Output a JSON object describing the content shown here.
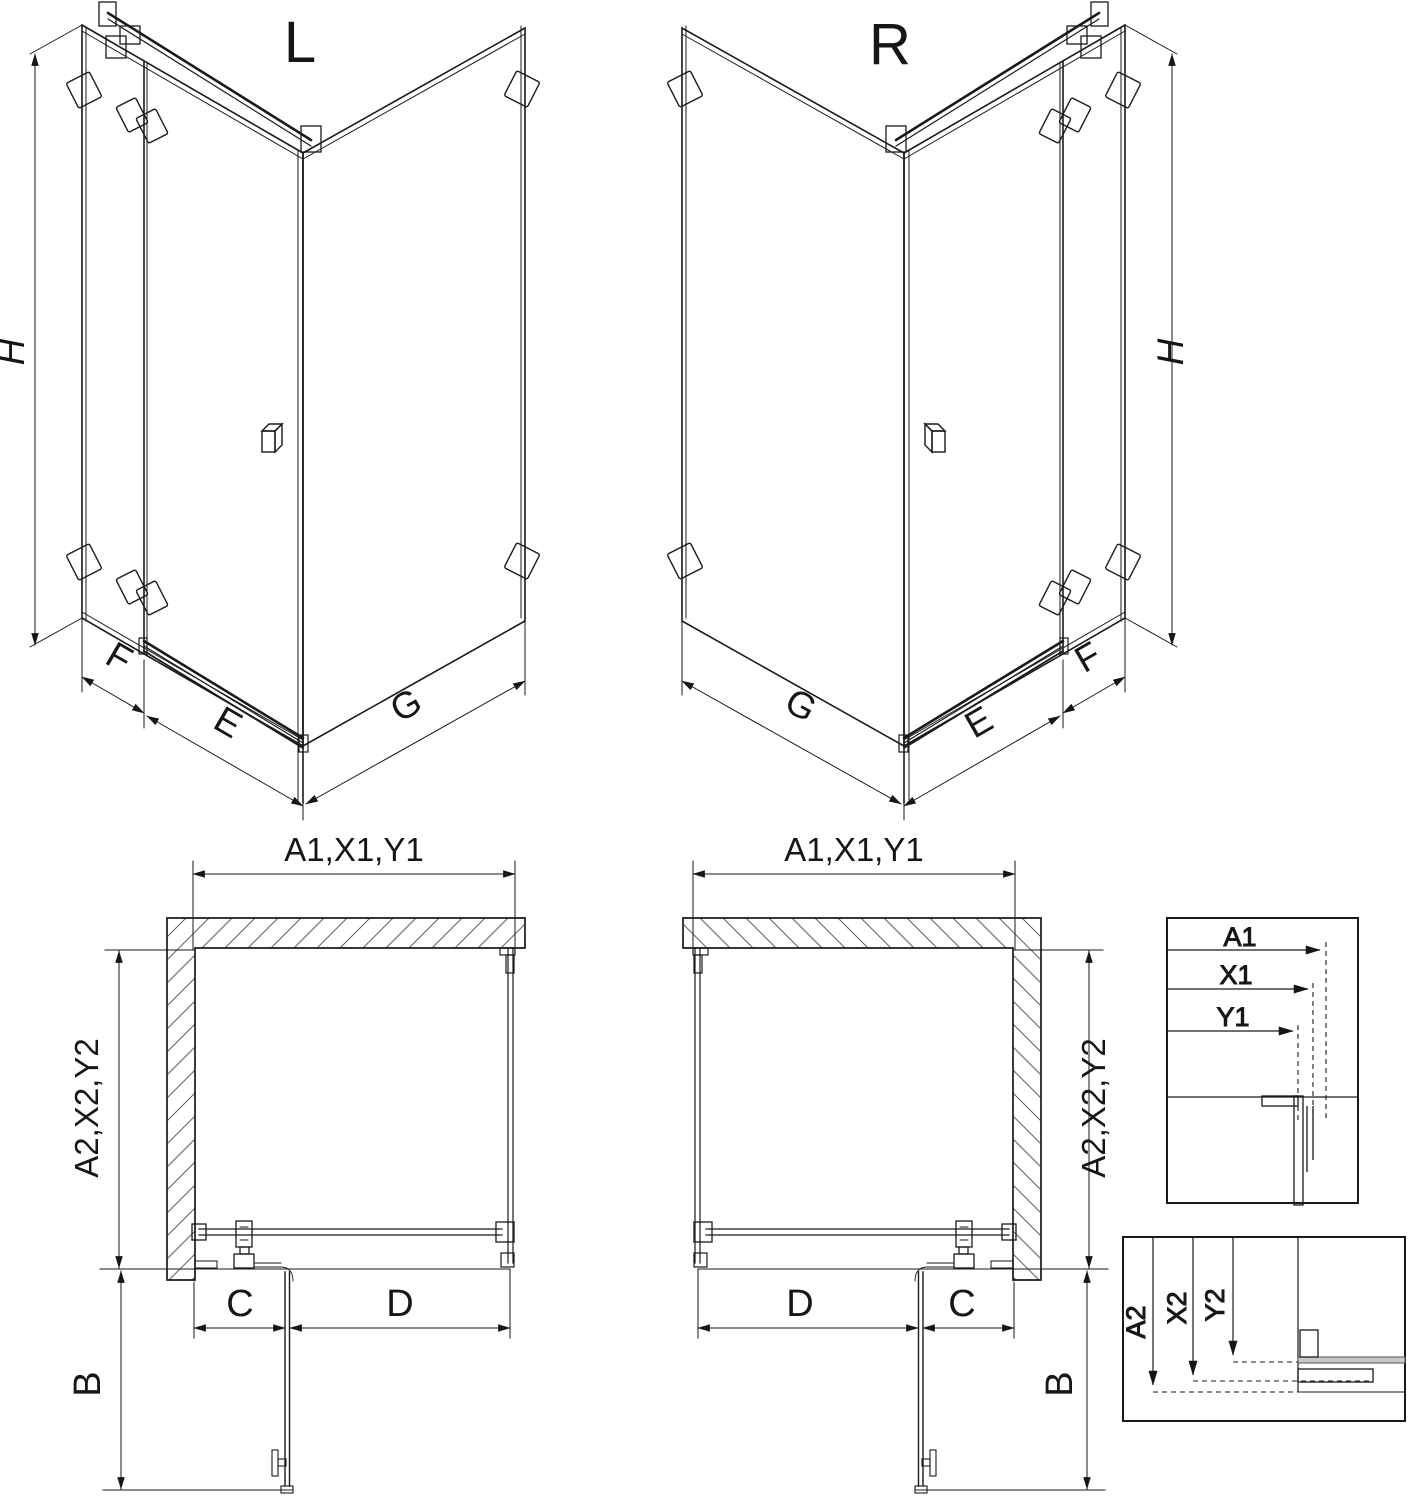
{
  "iso": {
    "left": {
      "label": "L",
      "h": "H",
      "f": "F",
      "e": "E",
      "g": "G"
    },
    "right": {
      "label": "R",
      "h": "H",
      "f": "F",
      "e": "E",
      "g": "G"
    }
  },
  "plan": {
    "left": {
      "a1": "A1,X1,Y1",
      "a2": "A2,X2,Y2",
      "b": "B",
      "c": "C",
      "d": "D"
    },
    "right": {
      "a1": "A1,X1,Y1",
      "a2": "A2,X2,Y2",
      "b": "B",
      "c": "C",
      "d": "D"
    }
  },
  "detail_a1": {
    "a1": "A1",
    "x1": "X1",
    "y1": "Y1"
  },
  "detail_a2": {
    "a2": "A2",
    "x2": "X2",
    "y2": "Y2"
  },
  "colors": {
    "line": "#1a1a1a",
    "hatch": "#666666",
    "glass_gray": "#c8c8c8"
  }
}
